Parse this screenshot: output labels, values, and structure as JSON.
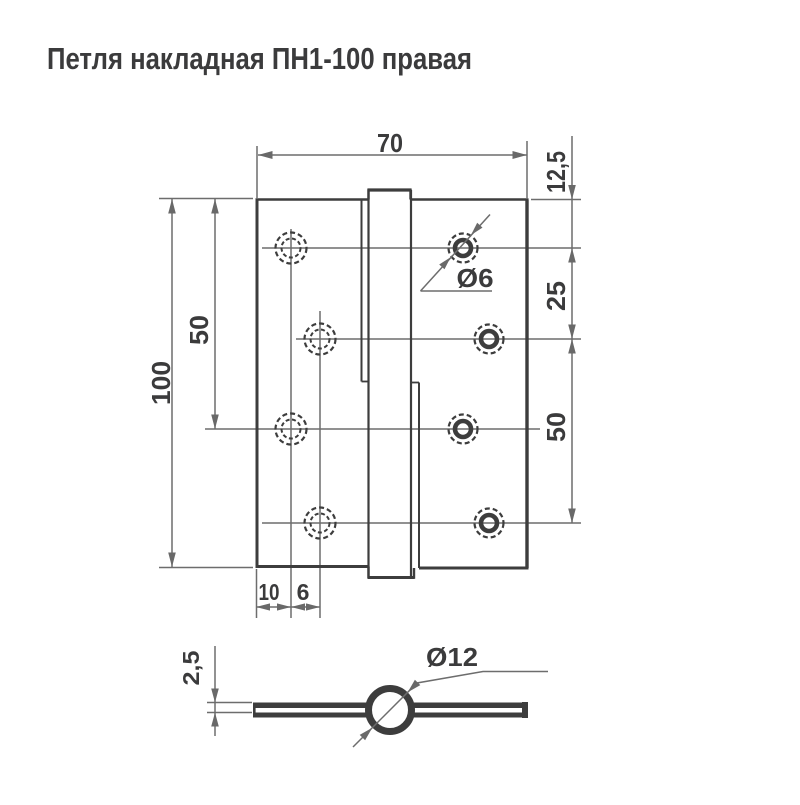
{
  "title": "Петля накладная ПН1-100 правая",
  "colors": {
    "background": "#ffffff",
    "object_line": "#3d3d3d",
    "dimension_line": "#6d6d6d",
    "text": "#3b3b3c"
  },
  "front_view": {
    "dim_width": "70",
    "dim_height": "100",
    "dim_left_hole_span": "50",
    "dim_top_offset": "12,5",
    "dim_upper_hole_span": "25",
    "dim_lower_hole_span": "50",
    "dim_edge_offset": "10",
    "dim_hole_stagger": "6",
    "dim_screw_hole_diameter": "Ø6"
  },
  "top_view": {
    "dim_plate_thickness": "2,5",
    "dim_barrel_diameter": "Ø12"
  }
}
